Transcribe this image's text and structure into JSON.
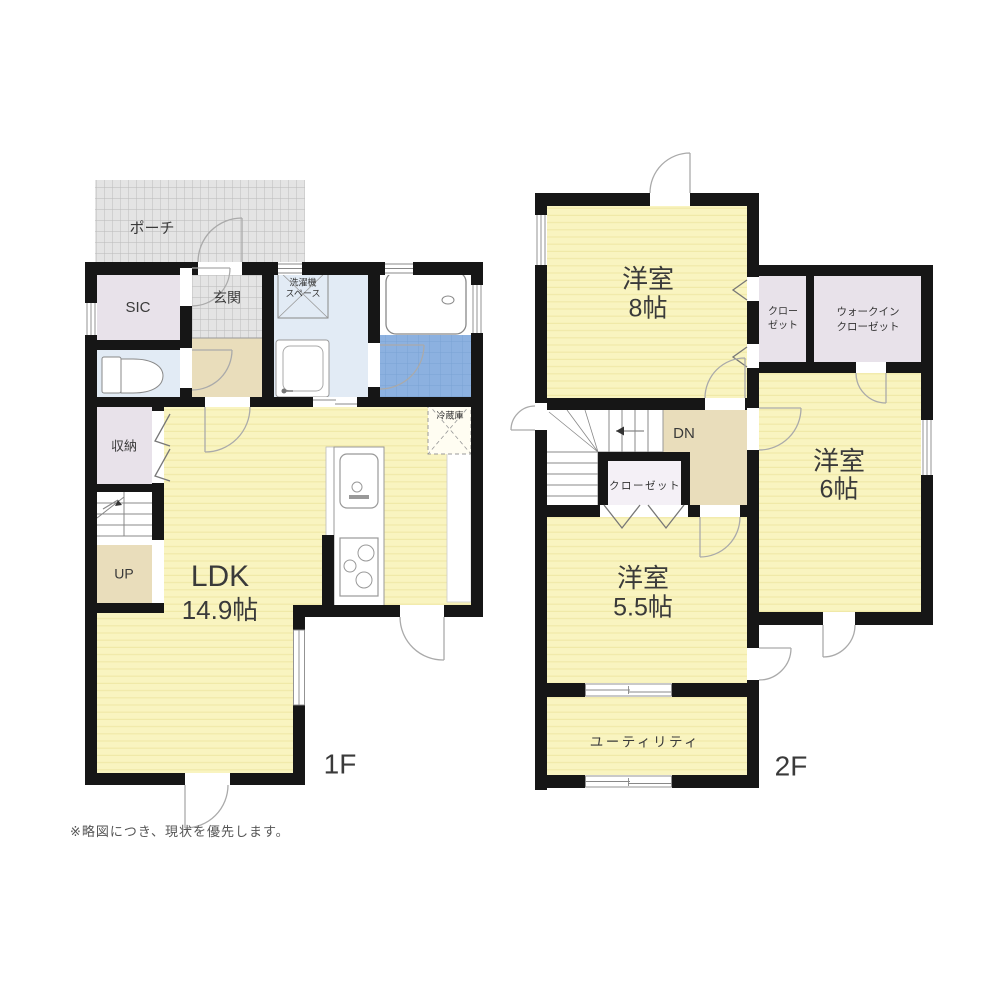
{
  "note": "※略図につき、現状を優先します。",
  "colors": {
    "wall": "#161616",
    "floor_yellow": "#f9f4c0",
    "floor_stripe": "#f0e9a8",
    "lavender": "#e8e2ea",
    "light_blue": "#e2ebf5",
    "tile_blue": "#8cb1e0",
    "beige": "#e9ddbb",
    "porch_gray": "#e4e4e4",
    "closet_white": "#f4f0f6"
  },
  "floor1": {
    "label": "1F",
    "rooms": {
      "porch": {
        "label": "ポーチ"
      },
      "sic": {
        "label": "SIC"
      },
      "genkan": {
        "label": "玄関"
      },
      "laundry": {
        "line1": "洗濯機",
        "line2": "スペース"
      },
      "storage": {
        "label": "収納"
      },
      "stairs": {
        "label": "UP"
      },
      "ldk": {
        "name": "LDK",
        "size": "14.9帖"
      },
      "fridge": {
        "label": "冷蔵庫"
      }
    }
  },
  "floor2": {
    "label": "2F",
    "rooms": {
      "room8": {
        "name": "洋室",
        "size": "8帖"
      },
      "closet_right": {
        "line1": "クロー",
        "line2": "ゼット"
      },
      "wic": {
        "line1": "ウォークイン",
        "line2": "クローゼット"
      },
      "room6": {
        "name": "洋室",
        "size": "6帖"
      },
      "stairs": {
        "label": "DN"
      },
      "closet_mid": {
        "label": "クローゼット"
      },
      "room55": {
        "name": "洋室",
        "size": "5.5帖"
      },
      "utility": {
        "label": "ユーティリティ"
      }
    }
  }
}
